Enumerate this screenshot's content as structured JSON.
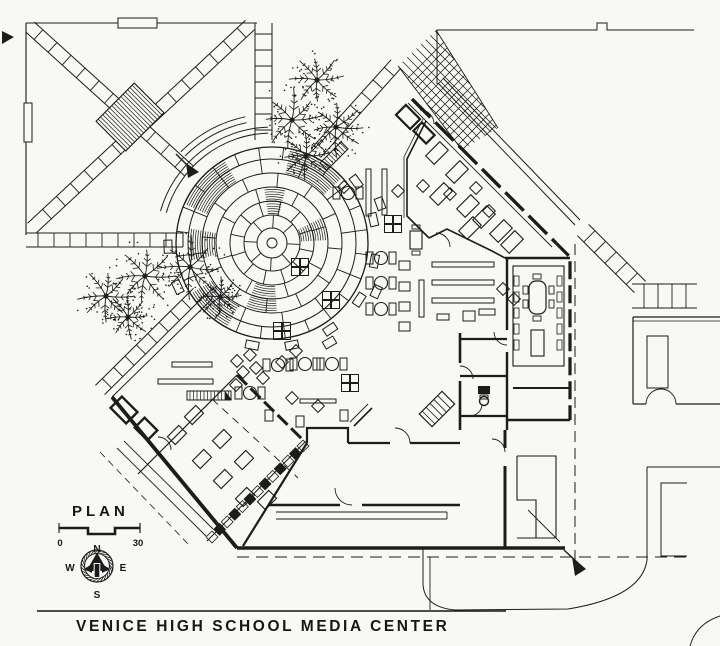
{
  "sheet": {
    "plan_label": "PLAN",
    "title": "VENICE HIGH SCHOOL MEDIA CENTER",
    "scale_bar": {
      "start_label": "0",
      "end_label": "30"
    },
    "compass": {
      "north": "N",
      "west": "W",
      "east": "E",
      "south": "S"
    },
    "colors": {
      "paper": "#f8f8f5",
      "ink": "#1c1c1c"
    }
  }
}
